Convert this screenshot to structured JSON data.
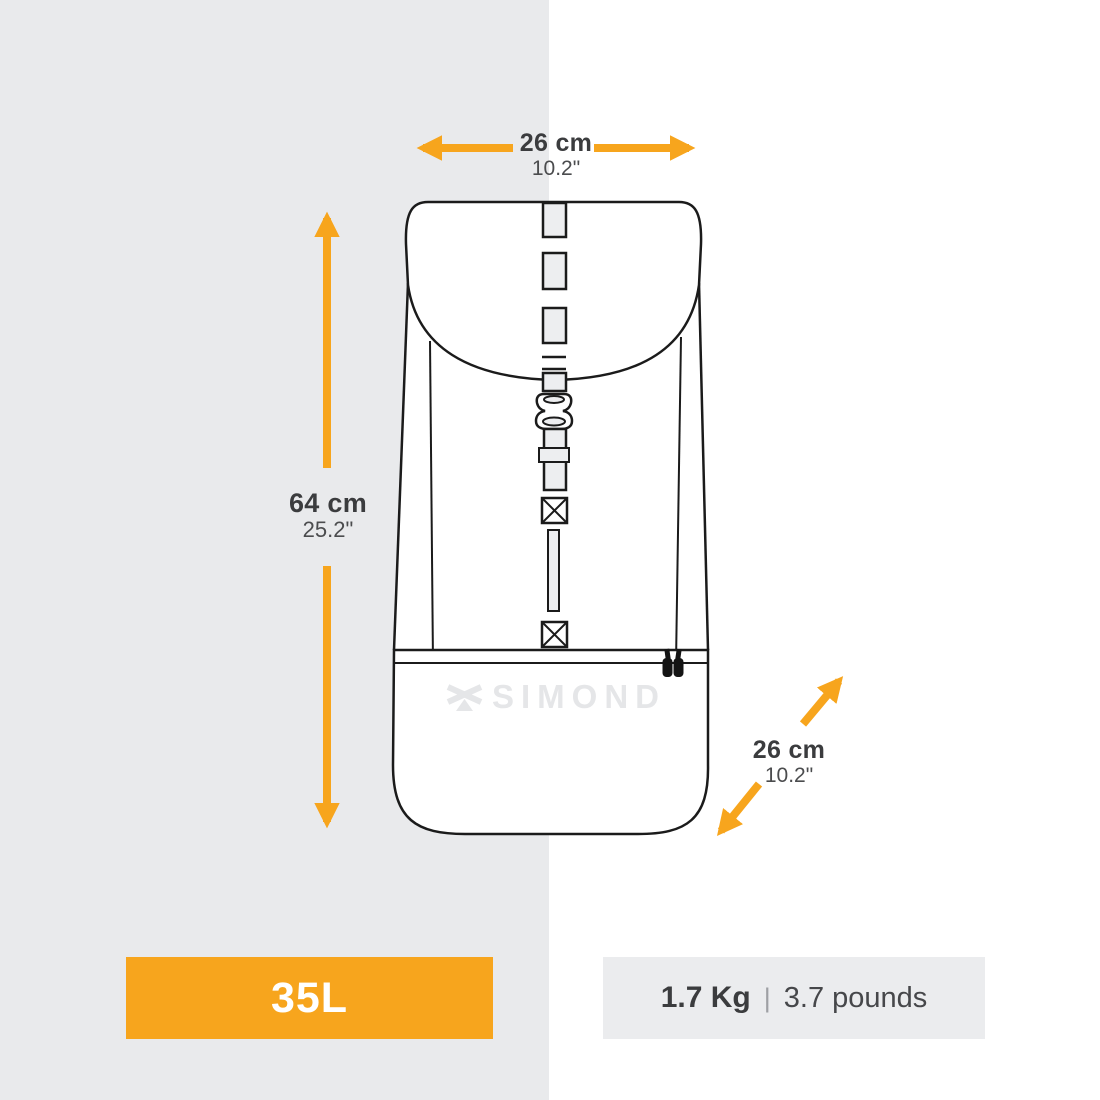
{
  "background": {
    "left_panel_color": "#E9EAEC"
  },
  "dimensions": {
    "width": {
      "cm": "26 cm",
      "inch": "10.2\""
    },
    "height": {
      "cm": "64 cm",
      "inch": "25.2\""
    },
    "depth": {
      "cm": "26 cm",
      "inch": "10.2\""
    }
  },
  "branding": {
    "logo_text": "SIMOND"
  },
  "volume_badge": {
    "label": "35L",
    "background": "#F7A51D"
  },
  "weight_badge": {
    "kg": "1.7 Kg",
    "separator": "|",
    "pounds": "3.7 pounds",
    "background": "#EBECEE"
  },
  "colors": {
    "accent_orange": "#F7A51D",
    "line_dark": "#1B1B1B",
    "text_dark": "#3B3C3E",
    "watermark_gray": "#E5E6E8"
  },
  "icons": {
    "width_arrows": "horizontal-double-arrows",
    "height_arrow": "vertical-double-arrow",
    "depth_arrows": "diagonal-double-arrows",
    "brand_icon": "simond-crossed-axes-logo",
    "zipper": "zipper-pulls"
  }
}
